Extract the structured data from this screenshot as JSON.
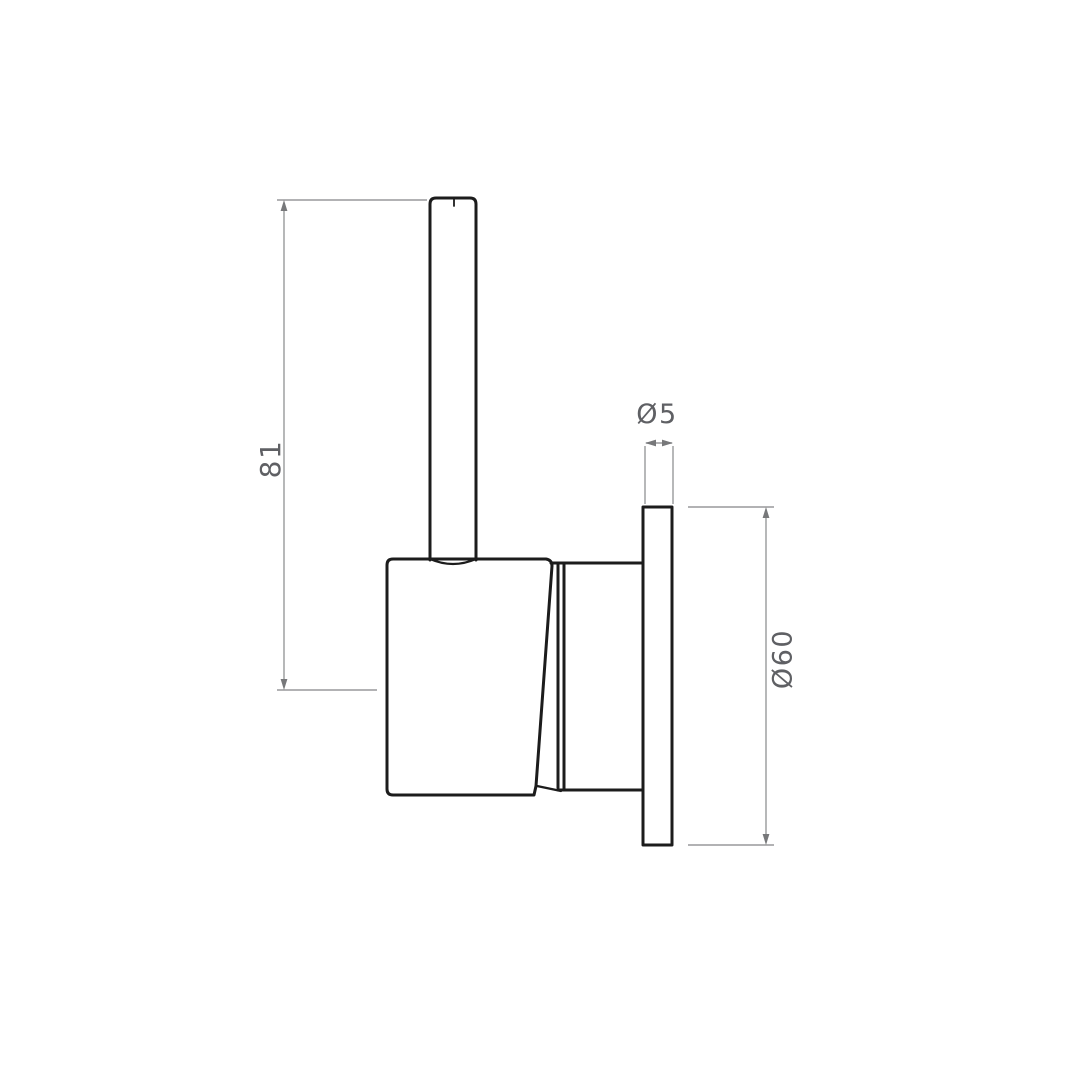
{
  "colors": {
    "background": "#ffffff",
    "part_line": "#1c1c1c",
    "dimension_line": "#98999b",
    "arrow": "#77787a",
    "label_text": "#5f6064"
  },
  "dimensions": {
    "lever_height": {
      "label": "81"
    },
    "plate_thickness": {
      "label": "Ø5"
    },
    "plate_diameter": {
      "label": "Ø60"
    }
  }
}
